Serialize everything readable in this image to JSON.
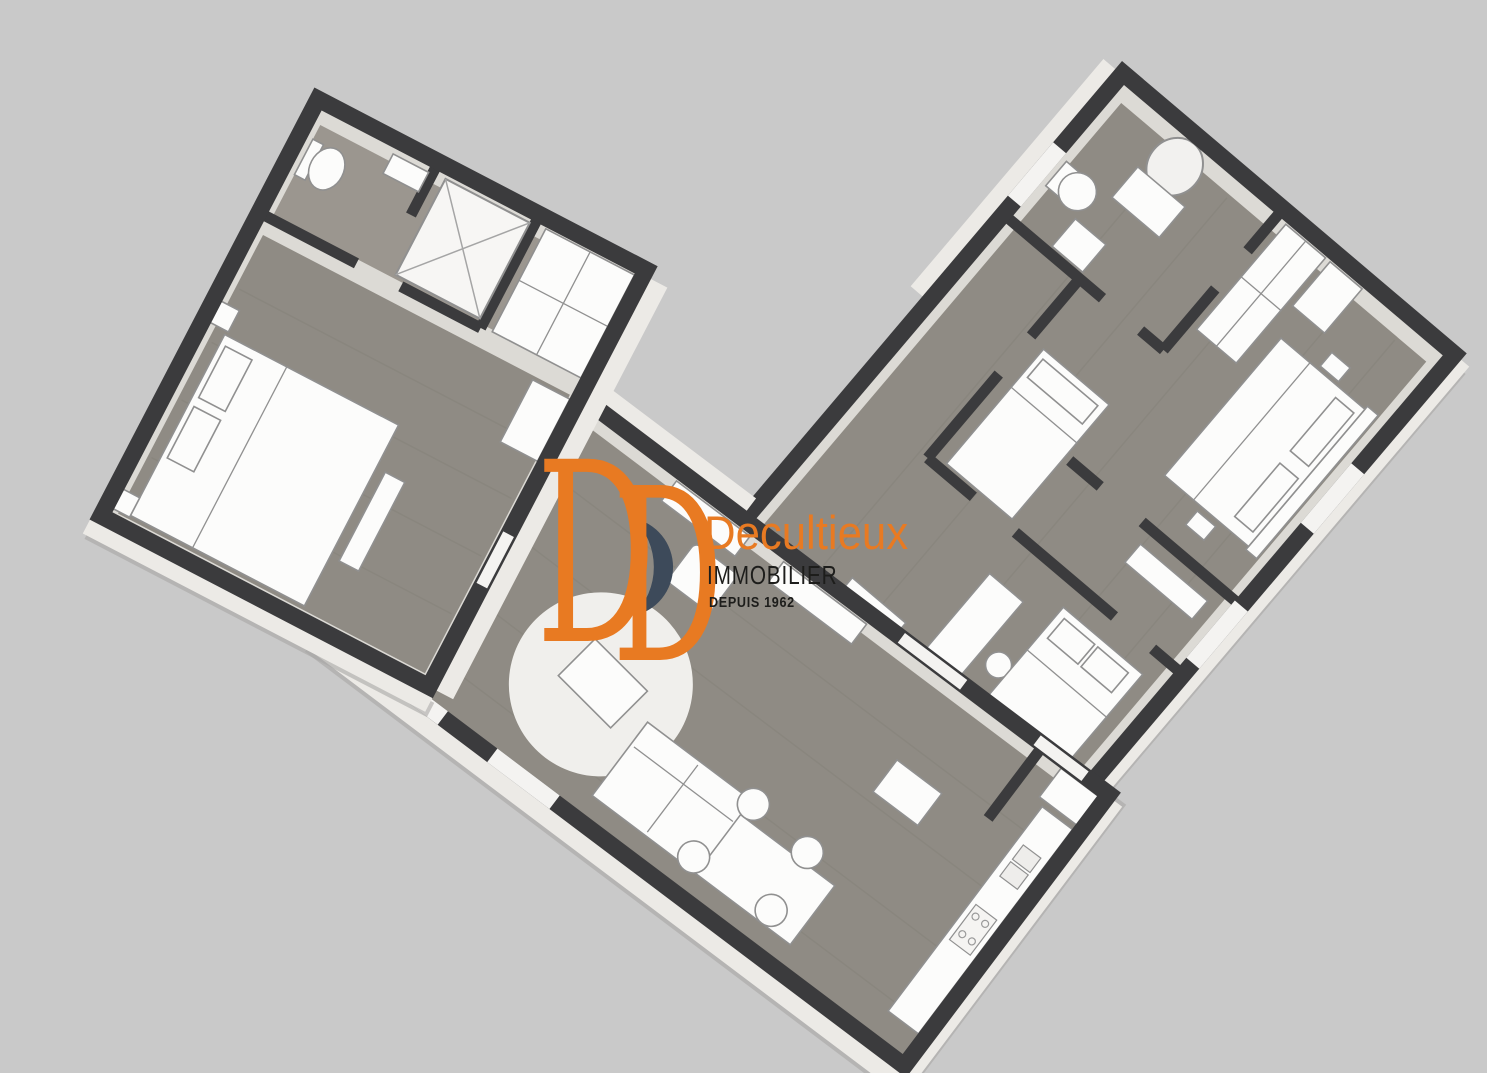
{
  "branding": {
    "monogram": [
      "D",
      "D"
    ],
    "name": "Decultieux",
    "sector": "IMMOBILIER",
    "since": "DEPUIS 1962"
  },
  "scene": {
    "description": "3D overhead floor plan of a V-shaped apartment: left wing with bedroom, bathroom and wardrobe; central wing with living room, dining area and kitchen; right wing with bathroom, hallway and three bedrooms",
    "colors": {
      "background": "#c9c9c9",
      "wall": "#3b3b3d",
      "interior_light": "#dcdad5",
      "wood": "#8f8b84",
      "wood_light": "#9b968f",
      "plank_line": "#7e7a72",
      "furniture_white": "#fcfcfb",
      "furniture_outline": "#909090",
      "rug": "#f0efec",
      "band_white": "#eceae6",
      "shadow": "#a8a7a5",
      "window_white": "#f4f3f1",
      "orange": "#e87a22",
      "navy": "#3d4a5a",
      "text_dark": "#1d1d1b"
    }
  }
}
